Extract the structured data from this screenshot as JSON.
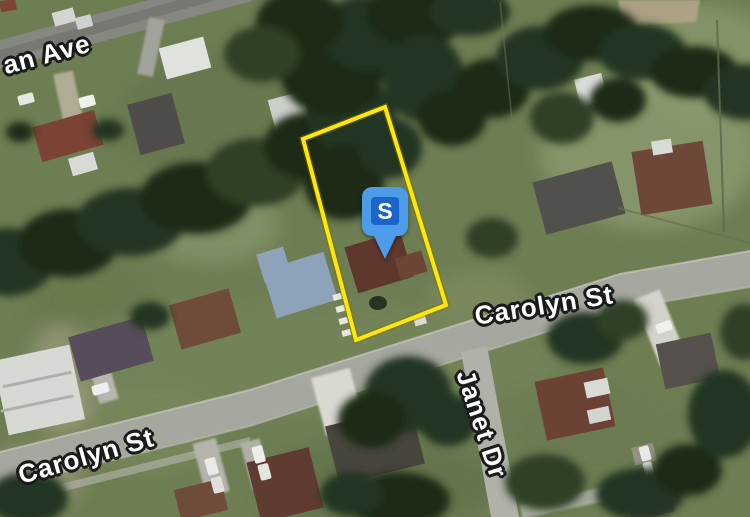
{
  "map": {
    "view_type": "satellite",
    "streets": {
      "ave_partial": "an Ave",
      "carolyn_left": "Carolyn St",
      "carolyn_right": "Carolyn St",
      "janet": "Janet Dr"
    },
    "marker": {
      "letter": "S",
      "body_color": "#4C9CEA",
      "square_color": "#1C64CA",
      "letter_color": "#FFFFFF"
    },
    "parcel": {
      "outline_color": "#FFE70D"
    }
  }
}
